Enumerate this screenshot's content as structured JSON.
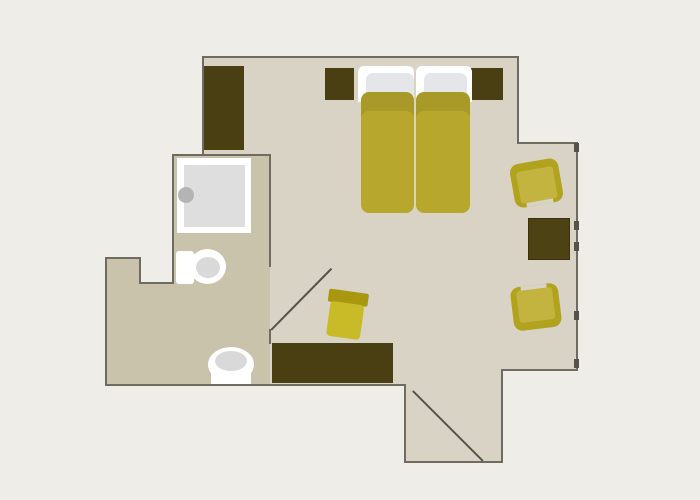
{
  "canvas": {
    "width": 700,
    "height": 500
  },
  "palette": {
    "background": "#efede8",
    "floorLight": "#d8d3c5",
    "floorDark": "#c9c3ac",
    "wall": "#6f6b60",
    "wallDark": "#55524b",
    "darkFurniture": "#4a3f13",
    "tableFill": "#4d4214",
    "tableBorder": "#3a320e",
    "bedBand": "#a89a28",
    "bedBody": "#b7a82d",
    "pillow": "#e4e6e9",
    "white": "#ffffff",
    "showerInner": "#dedede",
    "knob": "#b4b4b4",
    "toiletInner": "#d9d9d9",
    "chairOuter": "#b2a31f",
    "chairSeat": "#c2b43e",
    "stoolBand": "#a8970f",
    "stoolSeat": "#c9ba28"
  },
  "plan": {
    "floors": [
      {
        "name": "floor-main-room",
        "kind": "rect",
        "x": 203,
        "y": 57,
        "w": 315,
        "h": 313,
        "color": "floorLight"
      },
      {
        "name": "floor-main-room-lower",
        "kind": "rect",
        "x": 203,
        "y": 370,
        "w": 299,
        "h": 15,
        "color": "floorLight"
      },
      {
        "name": "floor-right-wing",
        "kind": "rect",
        "x": 518,
        "y": 143,
        "w": 59,
        "h": 227,
        "color": "floorLight"
      },
      {
        "name": "floor-entry-vestibule",
        "kind": "rect",
        "x": 405,
        "y": 385,
        "w": 97,
        "h": 77,
        "color": "floorLight"
      },
      {
        "name": "floor-bathroom",
        "kind": "rect",
        "x": 173,
        "y": 155,
        "w": 97,
        "h": 128,
        "color": "floorDark"
      },
      {
        "name": "floor-hall-left",
        "kind": "rect",
        "x": 106,
        "y": 258,
        "w": 34,
        "h": 127,
        "color": "floorDark"
      },
      {
        "name": "floor-hall-bottom",
        "kind": "rect",
        "x": 140,
        "y": 283,
        "w": 130,
        "h": 102,
        "color": "floorDark"
      }
    ],
    "walls": [
      {
        "name": "wall-top",
        "kind": "rect",
        "x": 203,
        "y": 56,
        "w": 316,
        "h": 2,
        "color": "wall"
      },
      {
        "name": "wall-left-upper",
        "kind": "rect",
        "x": 202,
        "y": 56,
        "w": 2,
        "h": 100,
        "color": "wall"
      },
      {
        "name": "wall-bathroom-top",
        "kind": "rect",
        "x": 172,
        "y": 154,
        "w": 99,
        "h": 2,
        "color": "wall"
      },
      {
        "name": "wall-bathroom-left",
        "kind": "rect",
        "x": 172,
        "y": 154,
        "w": 2,
        "h": 130,
        "color": "wall"
      },
      {
        "name": "wall-step-bottom",
        "kind": "rect",
        "x": 139,
        "y": 282,
        "w": 35,
        "h": 2,
        "color": "wall"
      },
      {
        "name": "wall-step-right",
        "kind": "rect",
        "x": 139,
        "y": 257,
        "w": 2,
        "h": 27,
        "color": "wall"
      },
      {
        "name": "wall-hall-top",
        "kind": "rect",
        "x": 105,
        "y": 257,
        "w": 36,
        "h": 2,
        "color": "wall"
      },
      {
        "name": "wall-hall-left",
        "kind": "rect",
        "x": 105,
        "y": 257,
        "w": 2,
        "h": 129,
        "color": "wall"
      },
      {
        "name": "wall-bottom",
        "kind": "rect",
        "x": 105,
        "y": 384,
        "w": 301,
        "h": 2,
        "color": "wall"
      },
      {
        "name": "wall-entry-left",
        "kind": "rect",
        "x": 404,
        "y": 384,
        "w": 2,
        "h": 79,
        "color": "wall"
      },
      {
        "name": "wall-entry-bottom",
        "kind": "rect",
        "x": 404,
        "y": 461,
        "w": 99,
        "h": 2,
        "color": "wall"
      },
      {
        "name": "wall-entry-right",
        "kind": "rect",
        "x": 501,
        "y": 369,
        "w": 2,
        "h": 94,
        "color": "wall"
      },
      {
        "name": "wall-wing-bottom",
        "kind": "rect",
        "x": 501,
        "y": 369,
        "w": 77,
        "h": 2,
        "color": "wall"
      },
      {
        "name": "wall-right",
        "kind": "rect",
        "x": 576,
        "y": 142,
        "w": 2,
        "h": 229,
        "color": "wall"
      },
      {
        "name": "wall-wing-top",
        "kind": "rect",
        "x": 517,
        "y": 142,
        "w": 61,
        "h": 2,
        "color": "wall"
      },
      {
        "name": "wall-right-upper",
        "kind": "rect",
        "x": 517,
        "y": 56,
        "w": 2,
        "h": 88,
        "color": "wall"
      },
      {
        "name": "wall-bathroom-right-upper",
        "kind": "rect",
        "x": 269,
        "y": 155,
        "w": 2,
        "h": 112,
        "color": "wall"
      },
      {
        "name": "wall-bathroom-right-stub",
        "kind": "rect",
        "x": 269,
        "y": 329,
        "w": 2,
        "h": 15,
        "color": "wall"
      }
    ],
    "doors": [
      {
        "name": "bathroom-door-leaf",
        "kind": "line",
        "x1": 271,
        "y1": 330,
        "x2": 331,
        "y2": 269,
        "t": 1.5,
        "color": "wallDark"
      },
      {
        "name": "entry-door-leaf",
        "kind": "line",
        "x1": 413,
        "y1": 391,
        "x2": 483,
        "y2": 461,
        "t": 1.5,
        "color": "wallDark"
      }
    ],
    "window_ticks": [
      {
        "name": "window-tick-1",
        "kind": "rect",
        "x": 574,
        "y": 143,
        "w": 5,
        "h": 9,
        "color": "wallDark"
      },
      {
        "name": "window-tick-2",
        "kind": "rect",
        "x": 574,
        "y": 221,
        "w": 5,
        "h": 9,
        "color": "wallDark"
      },
      {
        "name": "window-tick-3",
        "kind": "rect",
        "x": 574,
        "y": 242,
        "w": 5,
        "h": 9,
        "color": "wallDark"
      },
      {
        "name": "window-tick-4",
        "kind": "rect",
        "x": 574,
        "y": 311,
        "w": 5,
        "h": 9,
        "color": "wallDark"
      },
      {
        "name": "window-tick-5",
        "kind": "rect",
        "x": 574,
        "y": 359,
        "w": 5,
        "h": 9,
        "color": "wallDark"
      }
    ],
    "furniture": [
      {
        "name": "wardrobe",
        "kind": "rect",
        "x": 204,
        "y": 66,
        "w": 40,
        "h": 84,
        "color": "darkFurniture"
      },
      {
        "name": "nightstand-left",
        "kind": "rect",
        "x": 325,
        "y": 68,
        "w": 29,
        "h": 32,
        "color": "darkFurniture"
      },
      {
        "name": "nightstand-right",
        "kind": "rect",
        "x": 471,
        "y": 68,
        "w": 32,
        "h": 32,
        "color": "darkFurniture"
      },
      {
        "name": "mattress-left",
        "kind": "rect",
        "x": 358,
        "y": 66,
        "w": 56,
        "h": 36,
        "color": "white",
        "r": "6px 6px 0 0"
      },
      {
        "name": "mattress-right",
        "kind": "rect",
        "x": 416,
        "y": 66,
        "w": 56,
        "h": 36,
        "color": "white",
        "r": "6px 6px 0 0"
      },
      {
        "name": "pillow-left",
        "kind": "rect",
        "x": 366,
        "y": 73,
        "w": 48,
        "h": 27,
        "color": "pillow",
        "r": 7
      },
      {
        "name": "pillow-right",
        "kind": "rect",
        "x": 424,
        "y": 73,
        "w": 43,
        "h": 27,
        "color": "pillow",
        "r": 7
      },
      {
        "name": "duvet-left-band",
        "kind": "rect",
        "x": 361,
        "y": 92,
        "w": 53,
        "h": 32,
        "color": "bedBand",
        "r": 8
      },
      {
        "name": "duvet-right-band",
        "kind": "rect",
        "x": 416,
        "y": 92,
        "w": 54,
        "h": 32,
        "color": "bedBand",
        "r": 8
      },
      {
        "name": "duvet-left-body",
        "kind": "rect",
        "x": 361,
        "y": 111,
        "w": 53,
        "h": 102,
        "color": "bedBody",
        "r": 8
      },
      {
        "name": "duvet-right-body",
        "kind": "rect",
        "x": 416,
        "y": 111,
        "w": 54,
        "h": 102,
        "color": "bedBody",
        "r": 8
      },
      {
        "name": "desk",
        "kind": "rect",
        "x": 272,
        "y": 343,
        "w": 121,
        "h": 40,
        "color": "darkFurniture"
      },
      {
        "name": "coffee-table",
        "kind": "rect",
        "x": 528,
        "y": 218,
        "w": 42,
        "h": 42,
        "color": "tableFill",
        "border": "tableBorder"
      },
      {
        "name": "armchair-upper",
        "kind": "rect",
        "x": 512,
        "y": 161,
        "w": 49,
        "h": 44,
        "color": "chairOuter",
        "r": 9,
        "rotate": -10,
        "children": [
          {
            "name": "armchair-upper-seat",
            "kind": "rect",
            "x": 6,
            "y": 8,
            "w": 37,
            "h": 32,
            "color": "chairSeat",
            "r": 3
          },
          {
            "name": "armchair-upper-notch",
            "kind": "rect",
            "x": 11,
            "y": 40,
            "w": 27,
            "h": 4,
            "color": "floorLight"
          }
        ]
      },
      {
        "name": "armchair-lower",
        "kind": "rect",
        "x": 512,
        "y": 285,
        "w": 48,
        "h": 44,
        "color": "chairOuter",
        "r": 9,
        "rotate": -7,
        "children": [
          {
            "name": "armchair-lower-seat",
            "kind": "rect",
            "x": 6,
            "y": 4,
            "w": 36,
            "h": 32,
            "color": "chairSeat",
            "r": 3
          },
          {
            "name": "armchair-lower-notch",
            "kind": "rect",
            "x": 11,
            "y": 0,
            "w": 26,
            "h": 4,
            "color": "floorLight"
          }
        ]
      },
      {
        "name": "desk-stool",
        "kind": "rect",
        "x": 326,
        "y": 291,
        "w": 40,
        "h": 47,
        "color": "",
        "rotate": 8,
        "children": [
          {
            "name": "desk-stool-backrest",
            "kind": "rect",
            "x": 0,
            "y": 0,
            "w": 40,
            "h": 13,
            "color": "stoolBand",
            "r": 2
          },
          {
            "name": "desk-stool-seat",
            "kind": "rect",
            "x": 3,
            "y": 12,
            "w": 34,
            "h": 35,
            "color": "stoolSeat",
            "r": 4
          }
        ]
      },
      {
        "name": "shower-tray",
        "kind": "rect",
        "x": 177,
        "y": 158,
        "w": 74,
        "h": 75,
        "color": "white"
      },
      {
        "name": "shower-tray-inner",
        "kind": "rect",
        "x": 184,
        "y": 165,
        "w": 61,
        "h": 62,
        "color": "showerInner"
      },
      {
        "name": "shower-knob",
        "kind": "ellipse",
        "x": 178,
        "y": 187,
        "w": 16,
        "h": 16,
        "color": "knob"
      },
      {
        "name": "toilet-tank",
        "kind": "rect",
        "x": 176,
        "y": 251,
        "w": 18,
        "h": 33,
        "color": "white",
        "r": 3
      },
      {
        "name": "toilet-bowl",
        "kind": "ellipse",
        "x": 189,
        "y": 249,
        "w": 37,
        "h": 35,
        "color": "white"
      },
      {
        "name": "toilet-bowl-inner",
        "kind": "ellipse",
        "x": 196,
        "y": 257,
        "w": 24,
        "h": 21,
        "color": "toiletInner"
      },
      {
        "name": "bidet-bowl",
        "kind": "ellipse",
        "x": 208,
        "y": 347,
        "w": 46,
        "h": 35,
        "color": "white"
      },
      {
        "name": "bidet-tank",
        "kind": "rect",
        "x": 211,
        "y": 362,
        "w": 40,
        "h": 22,
        "color": "white"
      },
      {
        "name": "bidet-bowl-inner",
        "kind": "ellipse",
        "x": 215,
        "y": 351,
        "w": 32,
        "h": 20,
        "color": "toiletInner"
      }
    ]
  }
}
